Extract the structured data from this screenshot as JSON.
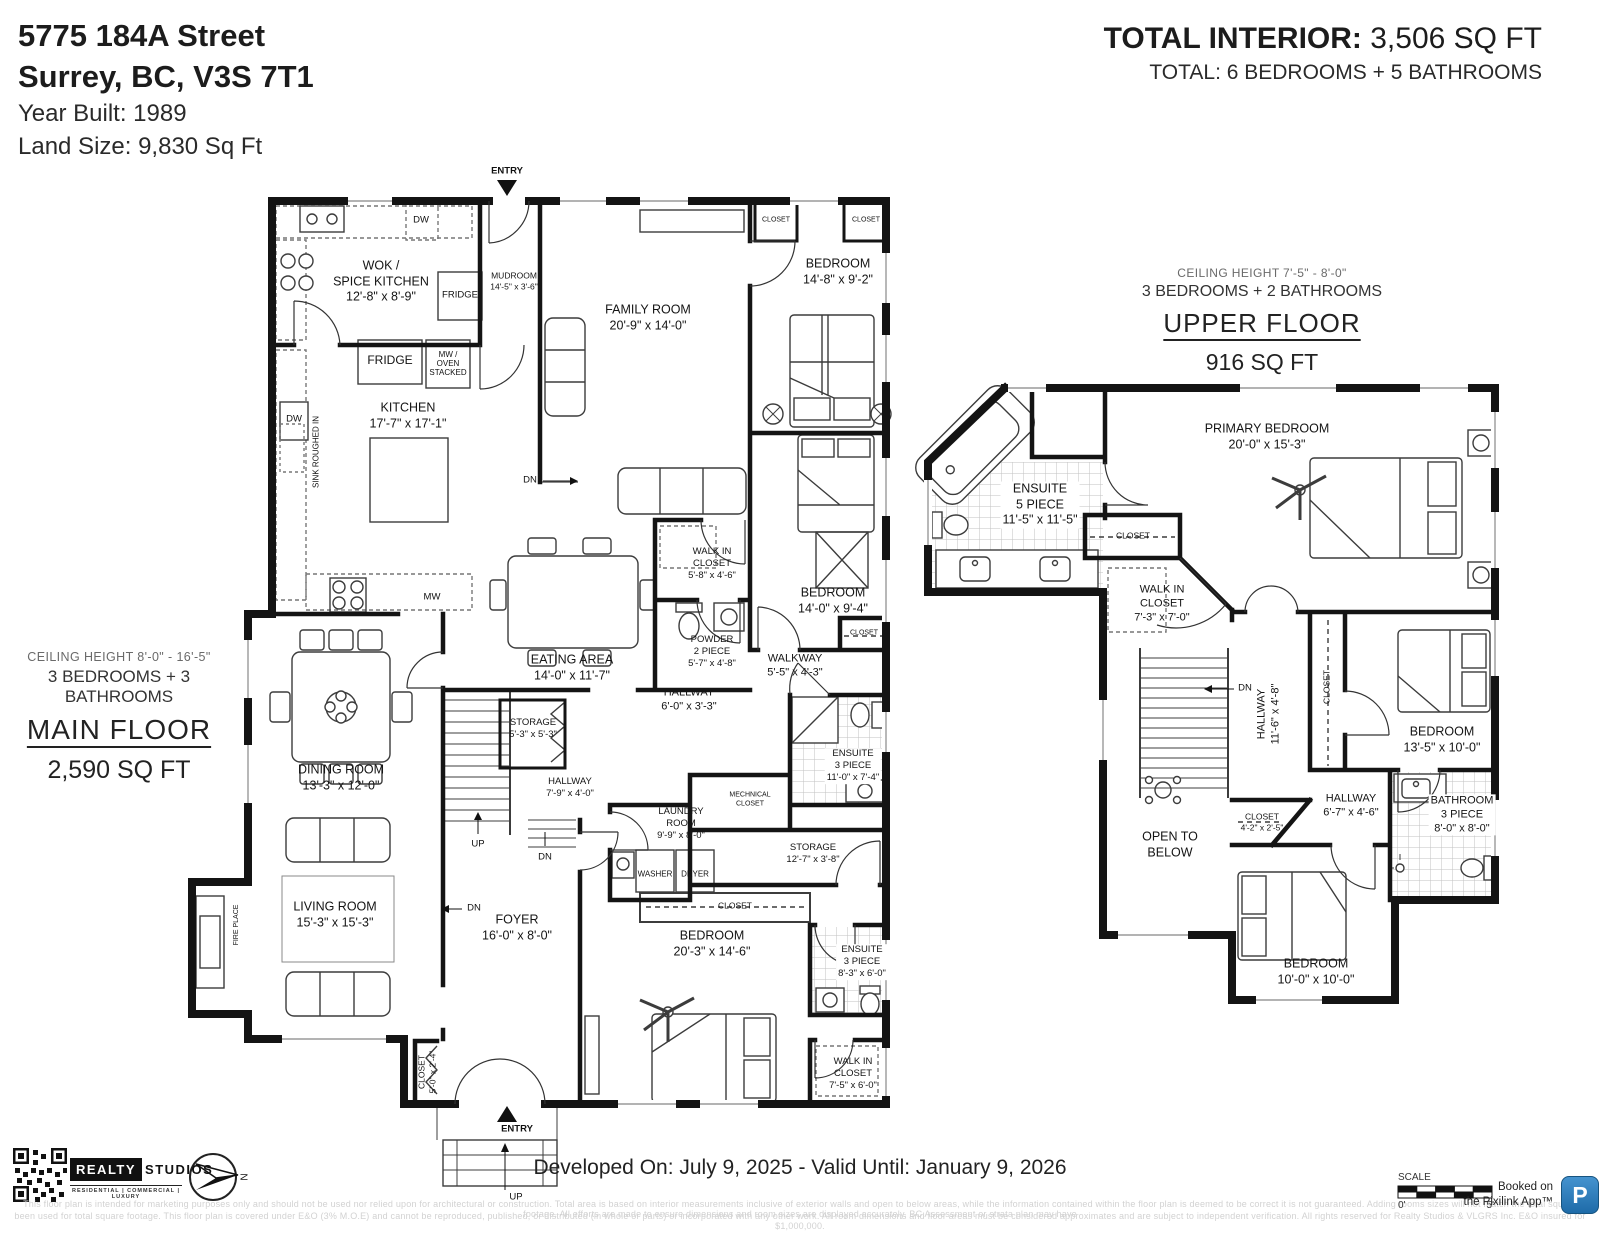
{
  "header": {
    "address_line1": "5775 184A Street",
    "address_line2": "Surrey, BC, V3S 7T1",
    "year_built": "Year Built: 1989",
    "land_size": "Land Size: 9,830 Sq Ft",
    "total_label": "TOTAL INTERIOR:",
    "total_value": "3,506 SQ FT",
    "total_rooms": "TOTAL: 6 BEDROOMS + 5 BATHROOMS"
  },
  "main_floor": {
    "ceiling": "CEILING HEIGHT 8'-0\" - 16'-5\"",
    "bed_bath": "3 BEDROOMS + 3 BATHROOMS",
    "title": "MAIN FLOOR",
    "area": "2,590 SQ FT",
    "rooms": [
      {
        "name": "WOK /\nSPICE KITCHEN",
        "dims": "12'-8\" x 8'-9\""
      },
      {
        "name": "MUDROOM",
        "dims": "14'-5\" x 3'-6\""
      },
      {
        "name": "FAMILY ROOM",
        "dims": "20'-9\" x 14'-0\""
      },
      {
        "name": "BEDROOM",
        "dims": "14'-8\" x 9'-2\""
      },
      {
        "name": "KITCHEN",
        "dims": "17'-7\" x 17'-1\""
      },
      {
        "name": "EATING AREA",
        "dims": "14'-0\" x 11'-7\""
      },
      {
        "name": "WALK IN\nCLOSET",
        "dims": "5'-8\" x 4'-6\""
      },
      {
        "name": "POWDER\n2 PIECE",
        "dims": "5'-7\" x 4'-8\""
      },
      {
        "name": "BEDROOM",
        "dims": "14'-0\" x 9'-4\""
      },
      {
        "name": "CLOSET",
        "dims": ""
      },
      {
        "name": "WALKWAY",
        "dims": "5'-5\" x 4'-3\""
      },
      {
        "name": "HALLWAY",
        "dims": "6'-0\" x 3'-3\""
      },
      {
        "name": "ENSUITE\n3 PIECE",
        "dims": "11'-0\" x 7'-4\""
      },
      {
        "name": "STORAGE",
        "dims": "5'-3\" x 5'-3\""
      },
      {
        "name": "HALLWAY",
        "dims": "7'-9\" x 4'-0\""
      },
      {
        "name": "LAUNDRY\nROOM",
        "dims": "9'-9\" x 8'-0\""
      },
      {
        "name": "MECHNICAL\nCLOSET",
        "dims": ""
      },
      {
        "name": "STORAGE",
        "dims": "12'-7\" x 3'-8\""
      },
      {
        "name": "CLOSET",
        "dims": ""
      },
      {
        "name": "DINING ROOM",
        "dims": "13'-3\" x 12'-0\""
      },
      {
        "name": "LIVING ROOM",
        "dims": "15'-3\" x 15'-3\""
      },
      {
        "name": "FOYER",
        "dims": "16'-0\" x 8'-0\""
      },
      {
        "name": "BEDROOM",
        "dims": "20'-3\" x 14'-6\""
      },
      {
        "name": "ENSUITE\n3 PIECE",
        "dims": "8'-3\" x 6'-0\""
      },
      {
        "name": "WALK IN\nCLOSET",
        "dims": "7'-5\" x 6'-0\""
      },
      {
        "name": "CLOSET",
        "dims": "5'-0\" x 2'-4\""
      },
      {
        "name": "CLOSET",
        "dims": ""
      },
      {
        "name": "CLOSET",
        "dims": ""
      }
    ],
    "notes": [
      {
        "text": "ENTRY"
      },
      {
        "text": "DW"
      },
      {
        "text": "FRIDGE"
      },
      {
        "text": "FRIDGE"
      },
      {
        "text": "MW /\nOVEN\nSTACKED"
      },
      {
        "text": "DW"
      },
      {
        "text": "SINK ROUGHED IN"
      },
      {
        "text": "MW"
      },
      {
        "text": "DN"
      },
      {
        "text": "UP"
      },
      {
        "text": "DN"
      },
      {
        "text": "DN"
      },
      {
        "text": "WASHER"
      },
      {
        "text": "DRYER"
      },
      {
        "text": "FIRE PLACE"
      },
      {
        "text": "ENTRY"
      },
      {
        "text": "UP"
      }
    ]
  },
  "upper_floor": {
    "ceiling": "CEILING HEIGHT 7'-5\" - 8'-0\"",
    "bed_bath": "3 BEDROOMS + 2 BATHROOMS",
    "title": "UPPER FLOOR",
    "area": "916 SQ FT",
    "rooms": [
      {
        "name": "ENSUITE\n5 PIECE",
        "dims": "11'-5\" x 11'-5\""
      },
      {
        "name": "PRIMARY BEDROOM",
        "dims": "20'-0\" x 15'-3\""
      },
      {
        "name": "CLOSET",
        "dims": ""
      },
      {
        "name": "WALK IN\nCLOSET",
        "dims": "7'-3\" x 7'-0\""
      },
      {
        "name": "HALLWAY",
        "dims": "11'-6\" x 4'-8\""
      },
      {
        "name": "CLOSET",
        "dims": ""
      },
      {
        "name": "BEDROOM",
        "dims": "13'-5\" x 10'-0\""
      },
      {
        "name": "HALLWAY",
        "dims": "6'-7\" x 4'-6\""
      },
      {
        "name": "CLOSET",
        "dims": "4'-2\" x 2'-5\""
      },
      {
        "name": "BATHROOM\n3 PIECE",
        "dims": "8'-0\" x 8'-0\""
      },
      {
        "name": "OPEN TO\nBELOW",
        "dims": ""
      },
      {
        "name": "BEDROOM",
        "dims": "10'-0\" x 10'-0\""
      }
    ],
    "notes": [
      {
        "text": "DN"
      }
    ]
  },
  "footer": {
    "developed": "Developed On: July 9, 2025 - Valid Until: January 9, 2026",
    "brand1": "REALTY",
    "brand2": "STUDIOS",
    "brand_tagline": "RESIDENTIAL | COMMERCIAL | LUXURY",
    "scale_label": "SCALE",
    "scale_0": "0'",
    "scale_5": "5'",
    "booked_line1": "Booked on",
    "booked_line2": "the Pixilink App™",
    "pix_letter": "P",
    "accent_blue": "#2e7bbf",
    "disclaimer_line1": "This floor plan is intended for marketing purposes only and should not be used nor relied upon for architectural or construction. Total area is based on interior measurements inclusive of exterior walls and open to below areas, while the information contained within the floor plan is deemed to be correct it is not guaranteed.  Adding rooms sizes will not match the total square footage. All efforts are made to ensure dimensions and room sizes are displayed accurately. BC Assessment or strata plan may have",
    "disclaimer_line2": "been used for total square footage. This floor plan is covered under E&O (3% M.O.E) and cannot be reproduced, published, or distributed (in whole or parts) or incorporated with any other work. All room dimensions and floor areas must be considered approximates and are subject to independent verification. All rights reserved for Realty Studios & VLGRS Inc. E&O insured for $1,000,000."
  }
}
